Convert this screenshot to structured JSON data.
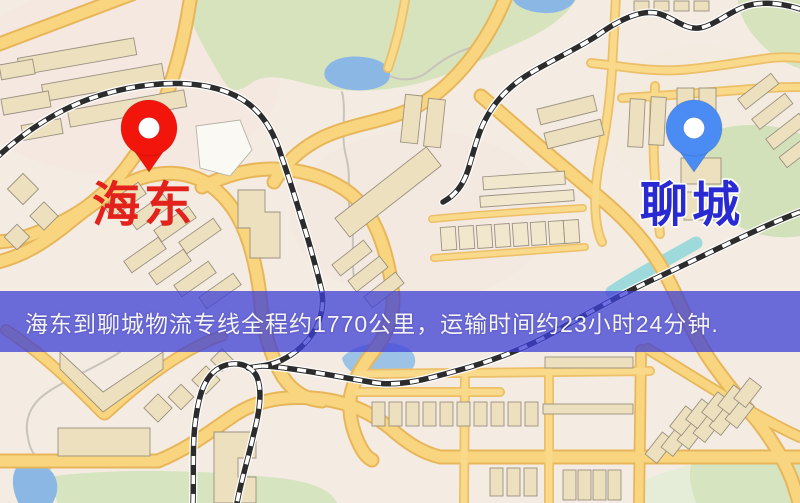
{
  "markers": {
    "origin": {
      "name": "海东",
      "pin_color": "#f2150b",
      "label_color": "#e3231b"
    },
    "destination": {
      "name": "聊城",
      "pin_color": "#4a8cf4",
      "label_color": "#2a2ad2",
      "label_outline": "#ffffff"
    }
  },
  "banner": {
    "text": "海东到聊城物流专线全程约1770公里，运输时间约23小时24分钟.",
    "background": "rgba(62,63,214,0.75)",
    "text_color": "#f3f3f8"
  }
}
